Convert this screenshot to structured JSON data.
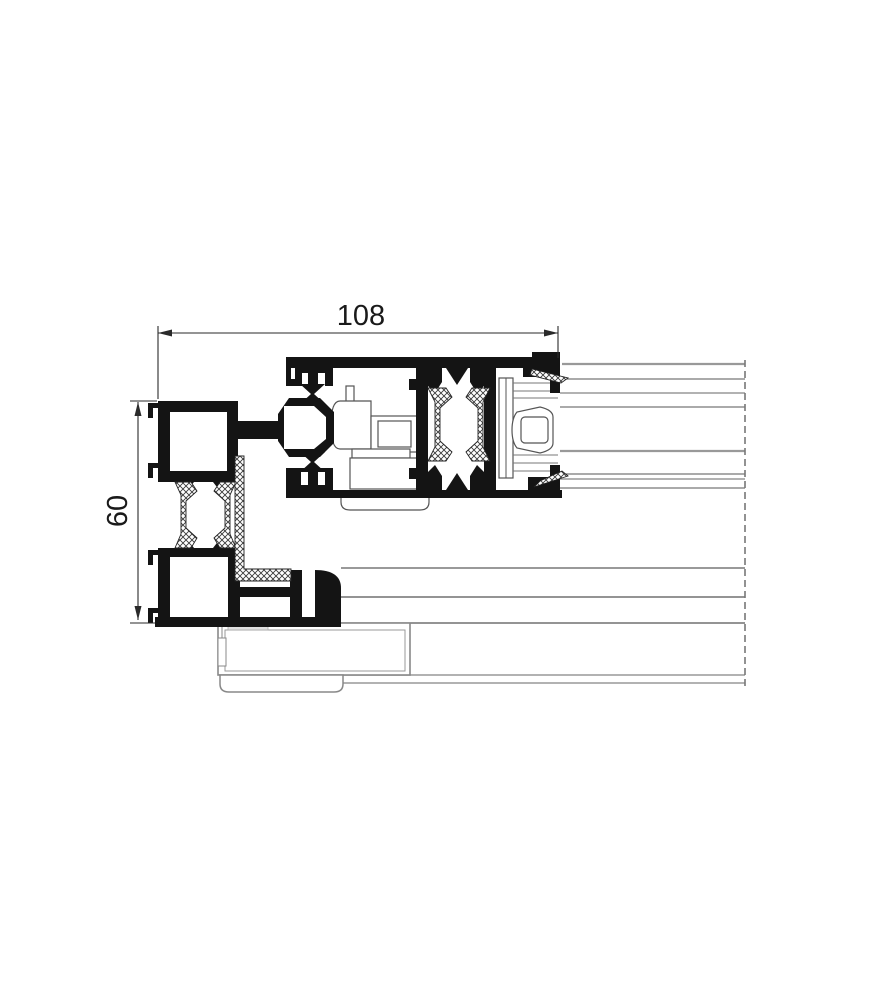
{
  "meta": {
    "description": "Technical cross-section drawing of an aluminium sliding window frame profile with sash interlock, thermal breaks, glazing panel and sill"
  },
  "dimensions": {
    "width_label": "108",
    "height_label": "60"
  },
  "style": {
    "profile_color": "#141414",
    "thin_line_color": "#555555",
    "panel_line_color": "#999999",
    "dimension_color": "#2a2a2a",
    "background": "#ffffff"
  }
}
